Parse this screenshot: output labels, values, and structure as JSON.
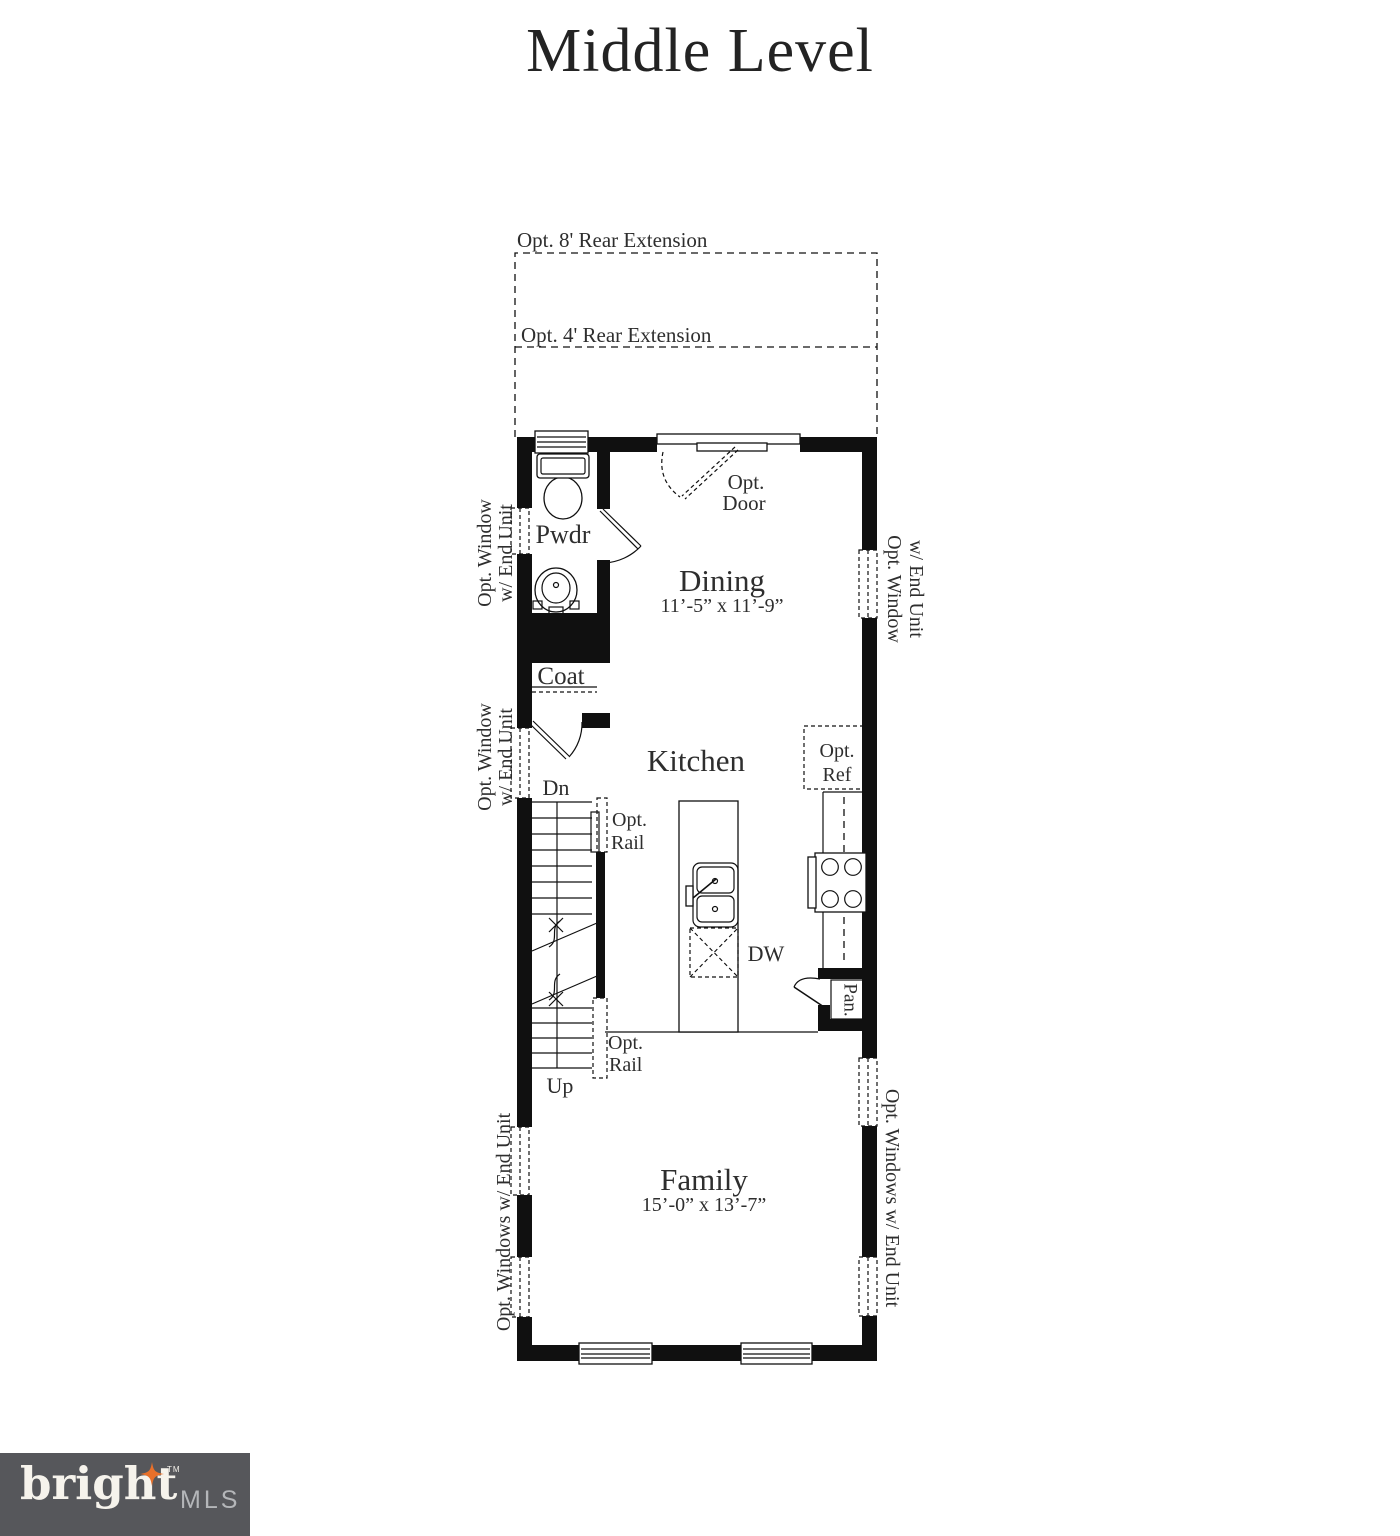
{
  "title": "Middle Level",
  "extension": {
    "opt8": "Opt. 8' Rear Extension",
    "opt4": "Opt. 4' Rear Extension"
  },
  "rooms": {
    "pwdr": "Pwdr",
    "coat": "Coat",
    "dining": "Dining",
    "dining_dim": "11’-5” x 11’-9”",
    "kitchen": "Kitchen",
    "family": "Family",
    "family_dim": "15’-0” x 13’-7”",
    "pantry": "Pan."
  },
  "labels": {
    "opt": "Opt.",
    "door": "Door",
    "ref": "Ref",
    "rail": "Rail",
    "dw": "DW",
    "dn": "Dn",
    "up": "Up"
  },
  "window_labels": {
    "line1": "Opt. Window",
    "line2": "w/ End Unit",
    "plural": "Opt. Windows w/ End Unit"
  },
  "logo": {
    "brand": "bright",
    "tm": "TM",
    "suffix": "MLS"
  },
  "colors": {
    "wall": "#101010",
    "text": "#2e2e2e",
    "logo_bg": "#56575b",
    "logo_text": "#f6f3ec",
    "logo_star": "#e8702a",
    "logo_mls": "#b4b6b9"
  }
}
